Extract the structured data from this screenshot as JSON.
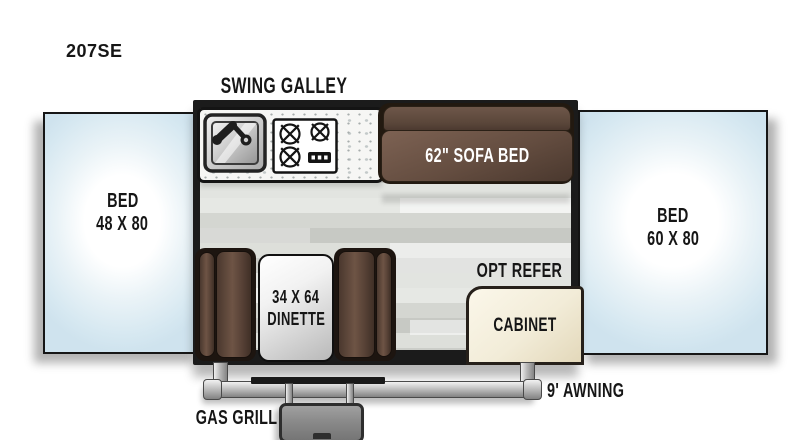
{
  "plan": {
    "model": "207SE",
    "callouts": {
      "swing_galley": "SWING GALLEY",
      "opt_refer": "OPT REFER",
      "gas_grill": "GAS GRILL",
      "awning": "9' AWNING"
    },
    "furniture": {
      "bed_left": {
        "name": "BED",
        "size": "48 X 80"
      },
      "bed_right": {
        "name": "BED",
        "size": "60 X 80"
      },
      "sofa_bed": {
        "label": "62\" SOFA BED"
      },
      "dinette": {
        "size": "34 X 64",
        "name": "DINETTE"
      },
      "cabinet": {
        "label": "CABINET"
      }
    },
    "icons": {
      "sink": "kitchen-sink-icon",
      "stove": "stove-burners-icon"
    },
    "colors": {
      "wall": "#1b1b1b",
      "bed_fill": "#d6e8f1",
      "upholstery_brown": "#5f4a3d",
      "cabinet_cream": "#f2ecd8",
      "floor_gray": "#d4d6d1",
      "metal_silver": "#c6c6c6"
    }
  }
}
